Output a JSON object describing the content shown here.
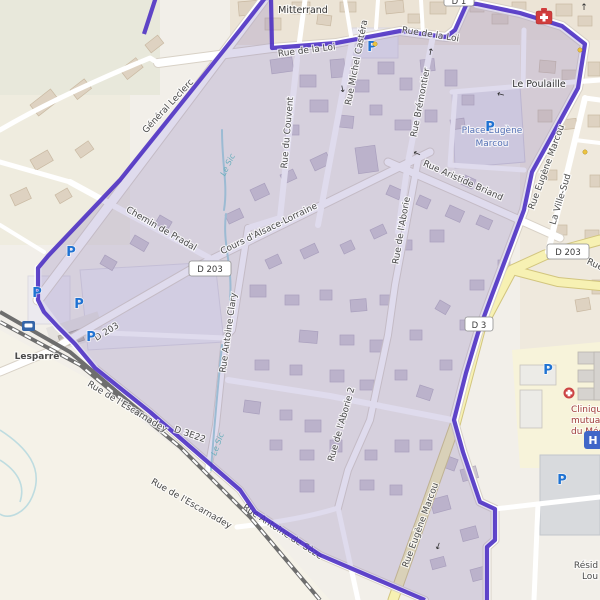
{
  "title": "Street map of Lesparre centre with highlighted boundary route",
  "labels": {
    "mitterrand": "Mitterrand",
    "le_poulaille": "Le Poulaille",
    "la_ville_sud": "La Ville-Sud",
    "place_eugene_1": "Place Eugène",
    "place_eugene_2": "Marcou",
    "lesparre": "Lesparre",
    "resid_1": "Résid",
    "resid_2": "Lou",
    "general_leclerc": "Général Leclerc",
    "rue_de_la_loi": "Rue de la Loi",
    "rue_michel_castera": "Rue Michel Castéra",
    "rue_bremontier": "Rue Brémontier",
    "rue_du_couvent": "Rue du Couvent",
    "rue_aristide_briand": "Rue Aristide Briand",
    "cours_alsace_lorraine": "Cours d'Alsace-Lorraine",
    "chemin_de_pradal": "Chemin de Pradal",
    "rue_antoine_clary": "Rue Antoine Clary",
    "rue_de_laborie": "Rue de l'Aborie",
    "rue_de_laborie_2": "Rue de l'Aborie 2",
    "rue_eugene_marcou": "Rue Eugène Marcou",
    "rue_escarnadey": "Rue de l'Escarnadey",
    "rue_antoine_de_seze": "Rue Antoine de Sèze",
    "rue_cut": "Rue",
    "le_sic": "Le Sic",
    "clinic_1": "Clinique",
    "clinic_2": "mutualiste",
    "clinic_3": "du Médoc"
  },
  "road_refs": {
    "d203": "D 203",
    "d3": "D 3",
    "d3e22": "D 3E22",
    "d1": "D 1"
  },
  "symbols": {
    "parking": "P",
    "hospital": "H",
    "arrow_up": "↑",
    "arrow_down": "↓",
    "arrow_left": "←"
  },
  "colors": {
    "route": "#4a2cc3",
    "highlight_fill": "rgba(150,136,195,0.30)",
    "road_yellow": "#f7f1b3",
    "water": "#9fd2da",
    "parking_blue": "#1f72d2",
    "place_blue": "#5572b5",
    "clinic_red": "#a03d3d",
    "base": "#f2efe9"
  }
}
